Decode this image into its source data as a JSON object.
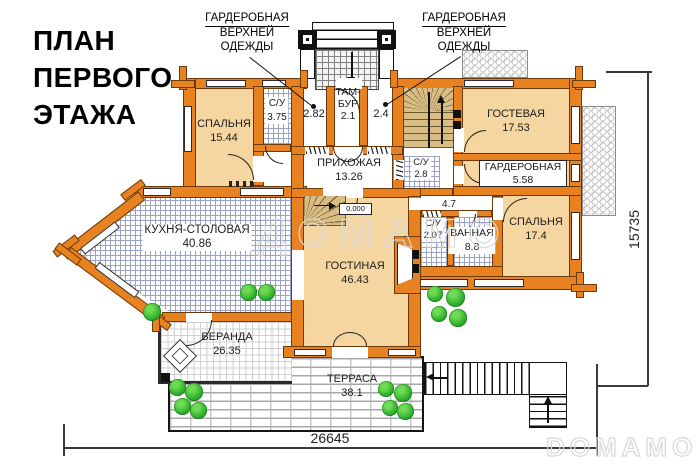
{
  "title": {
    "lines": [
      "ПЛАН",
      "ПЕРВОГО",
      "ЭТАЖА"
    ]
  },
  "annotations": {
    "wardrobe_left": {
      "lines": [
        "ГАРДЕРОБНАЯ",
        "ВЕРХНЕЙ",
        "ОДЕЖДЫ"
      ]
    },
    "wardrobe_right": {
      "lines": [
        "ГАРДЕРОБНАЯ",
        "ВЕРХНЕЙ",
        "ОДЕЖДЫ"
      ]
    }
  },
  "rooms": [
    {
      "id": "bedroom-1",
      "name": "СПАЛЬНЯ",
      "area": "15.44"
    },
    {
      "id": "wc-1",
      "name": "С/У",
      "area": "3.75"
    },
    {
      "id": "wardrobe-a",
      "name": "",
      "area": "2.82"
    },
    {
      "id": "tambour",
      "name": "ТАМБУР",
      "line1": "ТАМ-",
      "line2": "БУР",
      "area": "2.1"
    },
    {
      "id": "wardrobe-b",
      "name": "",
      "area": "2.4"
    },
    {
      "id": "hallway",
      "name": "ПРИХОЖАЯ",
      "area": "13.26"
    },
    {
      "id": "guest-room",
      "name": "ГОСТЕВАЯ",
      "area": "17.53"
    },
    {
      "id": "wardrobe",
      "name": "ГАРДЕРОБНАЯ",
      "area": "5.58"
    },
    {
      "id": "wc-2",
      "name": "С/У",
      "area": "2.8"
    },
    {
      "id": "corridor",
      "name": "",
      "area": "4.7"
    },
    {
      "id": "wc-3",
      "name": "С/У",
      "area": "2.07"
    },
    {
      "id": "bathroom",
      "name": "ВАННАЯ",
      "area": "8.8"
    },
    {
      "id": "bedroom-2",
      "name": "СПАЛЬНЯ",
      "area": "17.4"
    },
    {
      "id": "kitchen",
      "name": "КУХНЯ-СТОЛОВАЯ",
      "area": "40.86"
    },
    {
      "id": "living-room",
      "name": "ГОСТИНАЯ",
      "area": "46.43"
    },
    {
      "id": "veranda",
      "name": "ВЕРАНДА",
      "area": "26.35"
    },
    {
      "id": "terrace",
      "name": "ТЕРРАСА",
      "area": "38.1"
    }
  ],
  "level_mark": "0.000",
  "dimensions": {
    "width": "26645",
    "height": "15735"
  },
  "watermarks": {
    "center": "ДОМАМО",
    "corner": "DOMAMO"
  },
  "colors": {
    "wall": "#E8811F",
    "room_fill": "#F6D6A0",
    "tile_line": "#9aa3c6",
    "stair_wood": "#D9BD85",
    "plant": "#2fae2e",
    "text": "#1c1c1c",
    "watermark": "#d9d9d9"
  }
}
